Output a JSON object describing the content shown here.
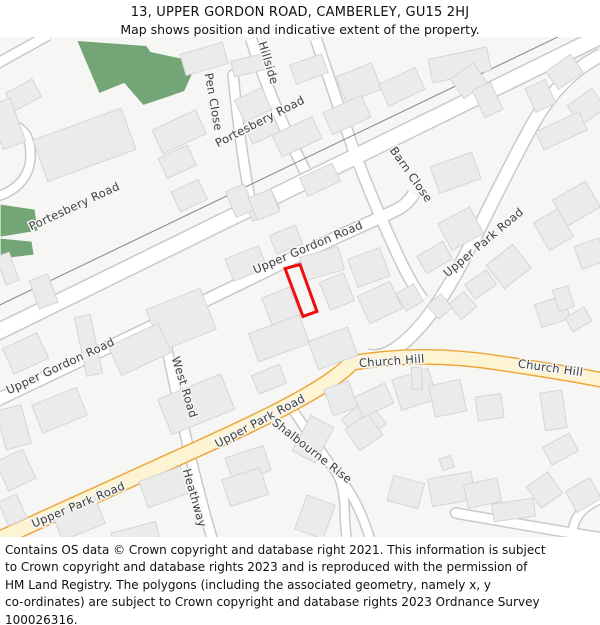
{
  "header": {
    "title": "13, UPPER GORDON ROAD, CAMBERLEY, GU15 2HJ",
    "subtitle": "Map shows position and indicative extent of the property."
  },
  "footer": {
    "lines": [
      "Contains OS data © Crown copyright and database right 2021. This information is subject",
      "to Crown copyright and database rights 2023 and is reproduced with the permission of",
      "HM Land Registry. The polygons (including the associated geometry, namely x, y",
      "co-ordinates) are subject to Crown copyright and database rights 2023 Ordnance Survey",
      "100026316."
    ]
  },
  "map": {
    "colors": {
      "background": "#f6f6f4",
      "building_fill": "#ebebeb",
      "building_stroke": "#d5d5d5",
      "road_fill": "#ffffff",
      "road_casing": "#c9c9c9",
      "primary_fill": "#fdf4d4",
      "primary_casing": "#eda63b",
      "green_area": "#74a576",
      "boundary_line": "#8f8f8f",
      "label_color": "#3f3f3f",
      "label_halo": "#f6f6f4",
      "property_outline": "#f10d0d"
    },
    "areas": [
      {
        "name": "woodland",
        "points": "77,40 146,45 150,51 183,58 193,70 184,90 170,95 143,104 124,82 99,92"
      },
      {
        "name": "green-strip-1",
        "points": "0,204 34,209 37,230 0,236"
      },
      {
        "name": "green-strip-2",
        "points": "0,238 31,241 33,254 0,258"
      }
    ],
    "boundary_line": {
      "path": "M -4,306 L 604,14"
    },
    "roads": [
      {
        "name": "Portesbery Road",
        "kind": "white",
        "path": "M -12,336 L 612,30",
        "w": 15
      },
      {
        "name": "corner-stub",
        "kind": "white",
        "path": "M -6,64 L 48,34",
        "w": 9
      },
      {
        "name": "left-hook",
        "kind": "white",
        "path": "M -4,196 C 16,190 30,176 30,154 C 30,138 24,128 12,124",
        "w": 8,
        "cap": "round"
      },
      {
        "name": "Pen Close",
        "kind": "white",
        "path": "M 233,74 C 237,118 243,162 251,204",
        "w": 9,
        "cap": "round"
      },
      {
        "name": "Hillside",
        "kind": "white",
        "path": "M 251,38 C 263,75 277,112 294,148 L 305,170",
        "w": 10
      },
      {
        "name": "Barn Close",
        "kind": "white",
        "path": "M 316,38 C 327,72 341,112 354,150 C 369,190 381,218 395,248 C 403,266 412,284 423,299",
        "w": 10
      },
      {
        "name": "Upper Gordon Road",
        "kind": "white",
        "path": "M -8,402 L 160,322 L 300,254 C 345,232 370,222 395,210 C 404,206 410,200 414,193",
        "w": 11
      },
      {
        "name": "West Road / Heathway",
        "kind": "white",
        "path": "M 161,322 C 172,372 181,420 193,468 C 199,492 205,516 213,542",
        "w": 9
      },
      {
        "name": "Upper Park Road north",
        "kind": "white",
        "path": "M 602,54 C 574,68 552,90 534,122 C 510,164 487,214 461,264 C 442,300 420,332 395,349 C 386,355 375,358 366,355",
        "w": 12
      },
      {
        "name": "Shalbourne Rise",
        "kind": "white",
        "path": "M 291,407 C 306,429 321,452 336,472 C 343,482 345,500 345,520 L 347,543",
        "w": 8
      },
      {
        "name": "Shalbourne branch",
        "kind": "white",
        "path": "M 338,476 C 352,492 363,514 371,542",
        "w": 8
      },
      {
        "name": "bottom-right cul-de-sac",
        "kind": "white",
        "path": "M 456,513 C 502,521 552,530 604,538",
        "w": 9,
        "cap": "round"
      },
      {
        "name": "bottom-right bend",
        "kind": "white",
        "path": "M 604,498 C 585,505 575,515 573,532",
        "w": 8
      },
      {
        "name": "Upper Park Road south",
        "kind": "yellow",
        "path": "M -8,542 L 210,443 C 258,421 302,400 332,379 C 340,373 346,369 352,362",
        "w": 14
      },
      {
        "name": "Church Hill",
        "kind": "yellow",
        "path": "M 350,363 C 400,354 452,355 502,363 C 536,368 570,373 604,380",
        "w": 13
      }
    ],
    "buildings": [
      {
        "x": 8,
        "y": 84,
        "w": 30,
        "h": 20,
        "r": -28
      },
      {
        "x": -6,
        "y": 100,
        "w": 24,
        "h": 46,
        "r": -20
      },
      {
        "x": 37,
        "y": 122,
        "w": 94,
        "h": 44,
        "r": -20
      },
      {
        "x": 155,
        "y": 118,
        "w": 48,
        "h": 26,
        "r": -25
      },
      {
        "x": 161,
        "y": 150,
        "w": 32,
        "h": 22,
        "r": -25
      },
      {
        "x": 174,
        "y": 184,
        "w": 30,
        "h": 22,
        "r": -25
      },
      {
        "x": 182,
        "y": 47,
        "w": 44,
        "h": 22,
        "r": -16
      },
      {
        "x": 232,
        "y": 56,
        "w": 36,
        "h": 16,
        "r": -14
      },
      {
        "x": 238,
        "y": 92,
        "w": 30,
        "h": 24,
        "r": -25
      },
      {
        "x": 247,
        "y": 118,
        "w": 30,
        "h": 20,
        "r": -25
      },
      {
        "x": 292,
        "y": 58,
        "w": 34,
        "h": 20,
        "r": -20
      },
      {
        "x": 340,
        "y": 68,
        "w": 38,
        "h": 28,
        "r": -22
      },
      {
        "x": 430,
        "y": 52,
        "w": 60,
        "h": 24,
        "r": -12
      },
      {
        "x": 455,
        "y": 68,
        "w": 28,
        "h": 24,
        "r": -35
      },
      {
        "x": 550,
        "y": 60,
        "w": 30,
        "h": 22,
        "r": -35
      },
      {
        "x": 572,
        "y": 94,
        "w": 30,
        "h": 24,
        "r": -35
      },
      {
        "x": 538,
        "y": 120,
        "w": 48,
        "h": 20,
        "r": -25
      },
      {
        "x": 275,
        "y": 124,
        "w": 44,
        "h": 24,
        "r": -25
      },
      {
        "x": 326,
        "y": 102,
        "w": 42,
        "h": 24,
        "r": -25
      },
      {
        "x": 382,
        "y": 74,
        "w": 40,
        "h": 24,
        "r": -25
      },
      {
        "x": 478,
        "y": 84,
        "w": 20,
        "h": 30,
        "r": -25
      },
      {
        "x": 530,
        "y": 82,
        "w": 22,
        "h": 26,
        "r": -25
      },
      {
        "x": 302,
        "y": 169,
        "w": 36,
        "h": 20,
        "r": -25
      },
      {
        "x": 247,
        "y": 195,
        "w": 30,
        "h": 20,
        "r": -25
      },
      {
        "x": 230,
        "y": 186,
        "w": 20,
        "h": 28,
        "r": -22
      },
      {
        "x": 252,
        "y": 192,
        "w": 24,
        "h": 24,
        "r": -22
      },
      {
        "x": 434,
        "y": 158,
        "w": 44,
        "h": 28,
        "r": -20
      },
      {
        "x": 558,
        "y": 188,
        "w": 38,
        "h": 30,
        "r": -30
      },
      {
        "x": 443,
        "y": 213,
        "w": 36,
        "h": 30,
        "r": -28
      },
      {
        "x": 540,
        "y": 213,
        "w": 28,
        "h": 32,
        "r": -30
      },
      {
        "x": 578,
        "y": 241,
        "w": 26,
        "h": 24,
        "r": -20
      },
      {
        "x": 492,
        "y": 251,
        "w": 34,
        "h": 30,
        "r": -38
      },
      {
        "x": 420,
        "y": 247,
        "w": 30,
        "h": 20,
        "r": -30
      },
      {
        "x": 468,
        "y": 275,
        "w": 26,
        "h": 18,
        "r": -35
      },
      {
        "x": 453,
        "y": 295,
        "w": 20,
        "h": 20,
        "r": -40
      },
      {
        "x": 431,
        "y": 297,
        "w": 18,
        "h": 18,
        "r": -40
      },
      {
        "x": 538,
        "y": 299,
        "w": 30,
        "h": 24,
        "r": -18
      },
      {
        "x": 556,
        "y": 287,
        "w": 16,
        "h": 22,
        "r": -18
      },
      {
        "x": 568,
        "y": 311,
        "w": 22,
        "h": 16,
        "r": -30
      },
      {
        "x": 0,
        "y": 253,
        "w": 14,
        "h": 30,
        "r": -20
      },
      {
        "x": 33,
        "y": 276,
        "w": 20,
        "h": 30,
        "r": -20
      },
      {
        "x": 6,
        "y": 339,
        "w": 38,
        "h": 28,
        "r": -25
      },
      {
        "x": 80,
        "y": 315,
        "w": 16,
        "h": 60,
        "r": -12
      },
      {
        "x": 152,
        "y": 297,
        "w": 58,
        "h": 44,
        "r": -22
      },
      {
        "x": 228,
        "y": 251,
        "w": 36,
        "h": 24,
        "r": -22
      },
      {
        "x": 272,
        "y": 229,
        "w": 28,
        "h": 20,
        "r": -22
      },
      {
        "x": 302,
        "y": 251,
        "w": 40,
        "h": 24,
        "r": -16
      },
      {
        "x": 266,
        "y": 291,
        "w": 30,
        "h": 30,
        "r": -22
      },
      {
        "x": 324,
        "y": 276,
        "w": 26,
        "h": 30,
        "r": -22
      },
      {
        "x": 352,
        "y": 252,
        "w": 34,
        "h": 30,
        "r": -20
      },
      {
        "x": 362,
        "y": 287,
        "w": 36,
        "h": 30,
        "r": -25
      },
      {
        "x": 400,
        "y": 287,
        "w": 20,
        "h": 20,
        "r": -30
      },
      {
        "x": 112,
        "y": 333,
        "w": 55,
        "h": 32,
        "r": -25
      },
      {
        "x": 162,
        "y": 385,
        "w": 68,
        "h": 38,
        "r": -22
      },
      {
        "x": 35,
        "y": 395,
        "w": 48,
        "h": 30,
        "r": -22
      },
      {
        "x": 0,
        "y": 407,
        "w": 26,
        "h": 40,
        "r": -15
      },
      {
        "x": 252,
        "y": 323,
        "w": 54,
        "h": 30,
        "r": -20
      },
      {
        "x": 312,
        "y": 333,
        "w": 42,
        "h": 30,
        "r": -20
      },
      {
        "x": 254,
        "y": 369,
        "w": 30,
        "h": 20,
        "r": -22
      },
      {
        "x": 328,
        "y": 384,
        "w": 26,
        "h": 28,
        "r": -20
      },
      {
        "x": 348,
        "y": 405,
        "w": 32,
        "h": 32,
        "r": -40
      },
      {
        "x": 396,
        "y": 373,
        "w": 38,
        "h": 32,
        "r": -18
      },
      {
        "x": 432,
        "y": 382,
        "w": 32,
        "h": 32,
        "r": -12
      },
      {
        "x": 412,
        "y": 367,
        "w": 10,
        "h": 22,
        "r": -3
      },
      {
        "x": 477,
        "y": 395,
        "w": 26,
        "h": 24,
        "r": -8
      },
      {
        "x": 543,
        "y": 391,
        "w": 22,
        "h": 38,
        "r": -8
      },
      {
        "x": 300,
        "y": 419,
        "w": 26,
        "h": 40,
        "r": 28
      },
      {
        "x": 350,
        "y": 419,
        "w": 28,
        "h": 26,
        "r": -35
      },
      {
        "x": 357,
        "y": 389,
        "w": 34,
        "h": 22,
        "r": -25
      },
      {
        "x": 390,
        "y": 479,
        "w": 32,
        "h": 26,
        "r": 15
      },
      {
        "x": 300,
        "y": 499,
        "w": 30,
        "h": 36,
        "r": 20
      },
      {
        "x": 0,
        "y": 454,
        "w": 30,
        "h": 32,
        "r": -25
      },
      {
        "x": 55,
        "y": 503,
        "w": 46,
        "h": 30,
        "r": -22
      },
      {
        "x": 142,
        "y": 473,
        "w": 44,
        "h": 28,
        "r": -20
      },
      {
        "x": 112,
        "y": 527,
        "w": 46,
        "h": 16,
        "r": -15
      },
      {
        "x": 228,
        "y": 451,
        "w": 40,
        "h": 26,
        "r": -18
      },
      {
        "x": 225,
        "y": 473,
        "w": 40,
        "h": 28,
        "r": -18
      },
      {
        "x": 430,
        "y": 475,
        "w": 44,
        "h": 28,
        "r": -10
      },
      {
        "x": 466,
        "y": 481,
        "w": 34,
        "h": 24,
        "r": -12
      },
      {
        "x": 493,
        "y": 501,
        "w": 42,
        "h": 18,
        "r": -8
      },
      {
        "x": 532,
        "y": 477,
        "w": 26,
        "h": 26,
        "r": -35
      },
      {
        "x": 570,
        "y": 483,
        "w": 28,
        "h": 24,
        "r": -30
      },
      {
        "x": 546,
        "y": 439,
        "w": 30,
        "h": 20,
        "r": -28
      },
      {
        "x": 441,
        "y": 457,
        "w": 12,
        "h": 12,
        "r": -20
      },
      {
        "x": 2,
        "y": 497,
        "w": 20,
        "h": 26,
        "r": -24
      }
    ],
    "property": {
      "label": "13 Upper Gordon Road indicative extent",
      "points": "285,268 300,264 317,311 303,316"
    },
    "labels": [
      {
        "text": "Portesbery Road",
        "x": 74,
        "y": 206,
        "r": -25
      },
      {
        "text": "Portesbery Road",
        "x": 260,
        "y": 121,
        "r": -27
      },
      {
        "text": "Pen Close",
        "x": 213,
        "y": 101,
        "r": 80
      },
      {
        "text": "Hillside",
        "x": 268,
        "y": 62,
        "r": 73
      },
      {
        "text": "Barn Close",
        "x": 411,
        "y": 174,
        "r": 55
      },
      {
        "text": "Upper Gordon Road",
        "x": 308,
        "y": 247,
        "r": -23
      },
      {
        "text": "Upper Gordon Road",
        "x": 60,
        "y": 366,
        "r": -25
      },
      {
        "text": "West Road",
        "x": 184,
        "y": 387,
        "r": 73
      },
      {
        "text": "Heathway",
        "x": 194,
        "y": 498,
        "r": 74
      },
      {
        "text": "Upper Park Road",
        "x": 484,
        "y": 242,
        "r": -40
      },
      {
        "text": "Upper Park Road",
        "x": 260,
        "y": 421,
        "r": -28
      },
      {
        "text": "Upper Park Road",
        "x": 78,
        "y": 505,
        "r": -23
      },
      {
        "text": "Church Hill",
        "x": 392,
        "y": 361,
        "r": -4
      },
      {
        "text": "Church Hill",
        "x": 551,
        "y": 368,
        "r": 8
      },
      {
        "text": "Shalbourne Rise",
        "x": 312,
        "y": 451,
        "r": 38
      }
    ]
  }
}
